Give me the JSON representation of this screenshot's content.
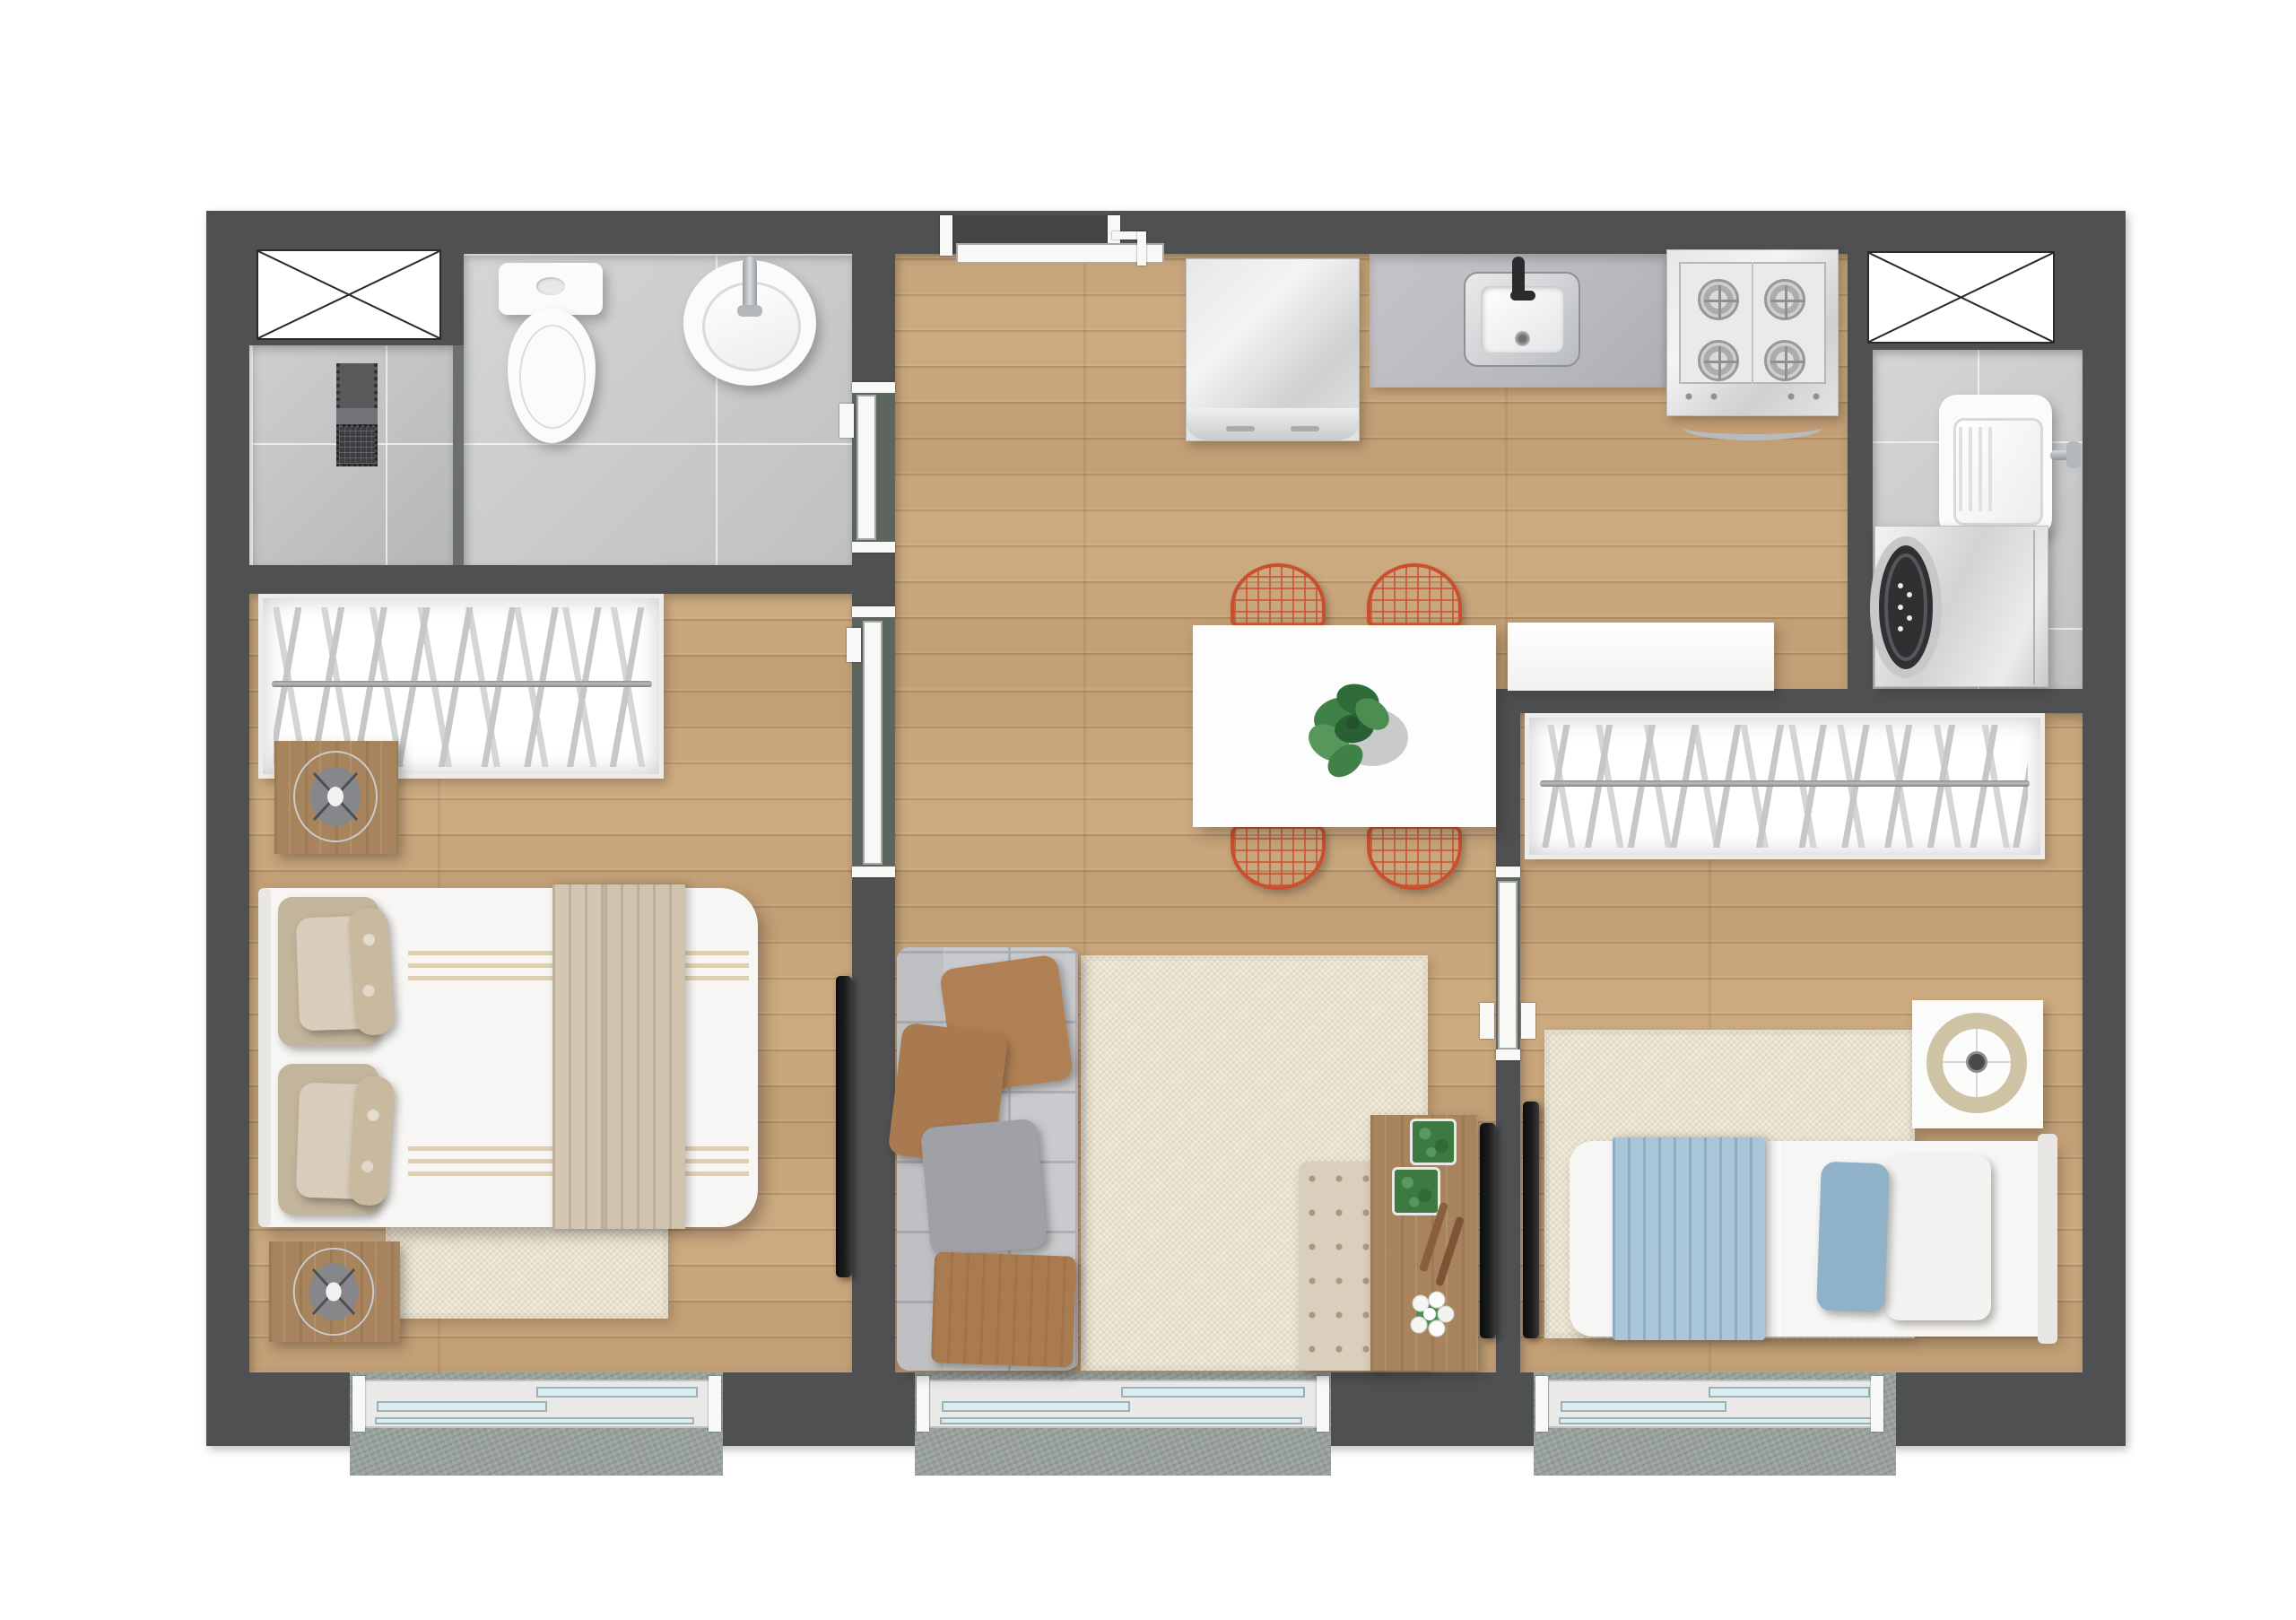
{
  "meta": {
    "kind": "apartment-floor-plan",
    "view": "top-down-render",
    "text_labels": []
  },
  "colors": {
    "page_bg": "#ffffff",
    "wall": "#4f5052",
    "wall_light": "#6a6f6c",
    "wood": "#c8a57b",
    "wood_line": "rgba(94,60,28,0.20)",
    "tile": "#c7c8ca",
    "tile_dark": "#bdbec0",
    "grout": "rgba(255,255,255,0.65)",
    "slab": "#9aa29e",
    "threshold": "#5d655f",
    "door": "#f8f8f6",
    "door_border": "#a8a8a6",
    "fixture": "#fbfbfa",
    "chrome": "#bfc2c5",
    "steel_hi": "#f3f4f6",
    "counter": "#b9babd",
    "black": "#1a1b1d",
    "rug": "#eae3cf",
    "sofa": "#c9cacd",
    "sofa_line": "#aeafb3",
    "pillow_brown": "#b07f53",
    "pillow_gray": "#9fa1a7",
    "throw": "#ab7b50",
    "table": "#fdfdfd",
    "chair": "#c8502f",
    "wood_furn": "#a8845e",
    "bed": "#f7f6f4",
    "blanket": "#cfc3ae",
    "stripe": "#dccfb4",
    "blue": "#a9c5d8",
    "blue_dark": "#8fb2c9",
    "tufted": "#d9cfbc",
    "glass": "#d9edf3",
    "frame": "#e9e9e7"
  },
  "rooms": [
    {
      "id": "bathroom",
      "floor": "gray-tile"
    },
    {
      "id": "shower-area",
      "floor": "gray-tile"
    },
    {
      "id": "kitchen-dining-living",
      "floor": "wood"
    },
    {
      "id": "laundry-area",
      "floor": "gray-tile"
    },
    {
      "id": "bedroom-1",
      "floor": "wood"
    },
    {
      "id": "bedroom-2",
      "floor": "wood"
    }
  ],
  "fixtures": {
    "bathroom": [
      "toilet",
      "round-washbasin",
      "shower-drain-column"
    ],
    "kitchen": [
      "refrigerator",
      "countertop-with-sink",
      "four-burner-stove"
    ],
    "laundry": [
      "laundry-tank-sink",
      "washing-machine"
    ],
    "dining": [
      "white-dining-table",
      "wire-chair x4",
      "monstera-plant",
      "white-sideboard-counter"
    ],
    "living": [
      "gray-tufted-sofa",
      "beige-rug",
      "tufted-bench",
      "wood-tv-stand",
      "tv",
      "planters x2",
      "white-flower"
    ],
    "bedroom-1": [
      "wardrobe-with-hangers",
      "double-bed",
      "nightstand x2",
      "fan-decor x2",
      "beige-rug",
      "wall-tv"
    ],
    "bedroom-2": [
      "wardrobe-with-hangers",
      "single-bed-blue-bedding",
      "white-nightstand-desk",
      "tray-decor",
      "beige-rug",
      "wall-tv"
    ],
    "openings": [
      "entry-door",
      "bathroom-door",
      "bedroom-1-door",
      "bedroom-2-door",
      "sliding-window x3",
      "duct-shaft x2"
    ]
  }
}
